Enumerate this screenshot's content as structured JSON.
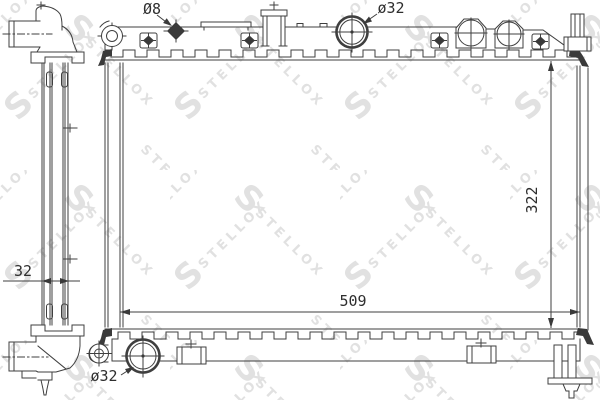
{
  "watermark": {
    "brand": "STELLOX",
    "logo_letter": "S"
  },
  "colors": {
    "line": "#3f3f3f",
    "text": "#2e2e2e",
    "watermark": "#e1e1e1",
    "background": "#ffffff"
  },
  "dimensions": {
    "mount_hole_diameter": {
      "label": "Ø8"
    },
    "inlet_diameter_top": {
      "label": "ø32"
    },
    "overall_height": {
      "label": "322"
    },
    "overall_width": {
      "label": "509"
    },
    "core_thickness": {
      "label": "32"
    },
    "outlet_diameter_bottom": {
      "label": "ø32"
    }
  }
}
